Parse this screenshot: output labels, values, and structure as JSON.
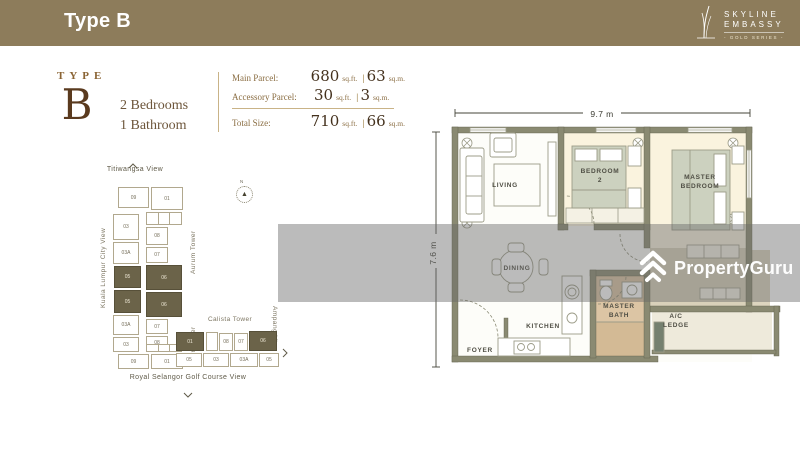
{
  "header": {
    "title": "Type B",
    "brand": {
      "line1": "SKYLINE",
      "line2": "EMBASSY",
      "line3": "- GOLD SERIES -"
    }
  },
  "summary": {
    "type_label": "TYPE",
    "type_letter": "B",
    "bedrooms": "2 Bedrooms",
    "bathrooms": "1 Bathroom",
    "rows": [
      {
        "label": "Main Parcel:",
        "sqft": "680",
        "sqft_unit": "sq.ft.",
        "sep": "|",
        "sqm": "63",
        "sqm_unit": "sq.m."
      },
      {
        "label": "Accessory Parcel:",
        "sqft": "30",
        "sqft_unit": "sq.ft.",
        "sep": "|",
        "sqm": "3",
        "sqm_unit": "sq.m."
      },
      {
        "label": "Total Size:",
        "sqft": "710",
        "sqft_unit": "sq.ft.",
        "sep": "|",
        "sqm": "66",
        "sqm_unit": "sq.m."
      }
    ]
  },
  "siteplan": {
    "compass": "N",
    "views": {
      "top": "Titiwangsa View",
      "left": "Kuala Lumpur City View",
      "right": "Ampang View",
      "bottom": "Royal Selangor Golf Course View"
    },
    "towers": [
      {
        "name": "Aurum Tower",
        "units": [
          {
            "label": "09"
          },
          {
            "label": "01"
          },
          {
            "label": "03"
          },
          {
            "label": "03A"
          },
          {
            "label": "08"
          },
          {
            "label": "07"
          },
          {
            "label": "05",
            "highlight": true
          },
          {
            "label": "06",
            "highlight": true
          }
        ]
      },
      {
        "name": "Brion Tower",
        "units": [
          {
            "label": "05",
            "highlight": true
          },
          {
            "label": "06",
            "highlight": true
          },
          {
            "label": "03A"
          },
          {
            "label": "07"
          },
          {
            "label": "08"
          },
          {
            "label": "03"
          },
          {
            "label": "09"
          },
          {
            "label": "01"
          }
        ]
      },
      {
        "name": "Calista Tower",
        "units": [
          {
            "label": "01",
            "highlight": true
          },
          {
            "label": "08"
          },
          {
            "label": "07"
          },
          {
            "label": "06",
            "highlight": true
          },
          {
            "label": "05"
          },
          {
            "label": "03"
          },
          {
            "label": "03A"
          },
          {
            "label": "05"
          }
        ]
      }
    ]
  },
  "floorplan": {
    "dims": {
      "width": "9.7 m",
      "height": "7.6 m"
    },
    "rooms": {
      "living": "LIVING",
      "bedroom2_l1": "BEDROOM",
      "bedroom2_l2": "2",
      "master_l1": "MASTER",
      "master_l2": "BEDROOM",
      "dining": "DINING",
      "kitchen": "KITCHEN",
      "bath_l1": "MASTER",
      "bath_l2": "BATH",
      "ac_l1": "A/C",
      "ac_l2": "LEDGE",
      "foyer": "FOYER"
    }
  },
  "watermark": {
    "text": "PropertyGuru"
  },
  "colors": {
    "bar": "#8d7c5b",
    "highlight_unit": "#6b6349",
    "bedroom_fill": "#faf3de",
    "bath_fill": "#dcc5a4",
    "wall": "#8a8a72",
    "type_brown": "#5a3a1e",
    "gold_text": "#8a6d42"
  }
}
